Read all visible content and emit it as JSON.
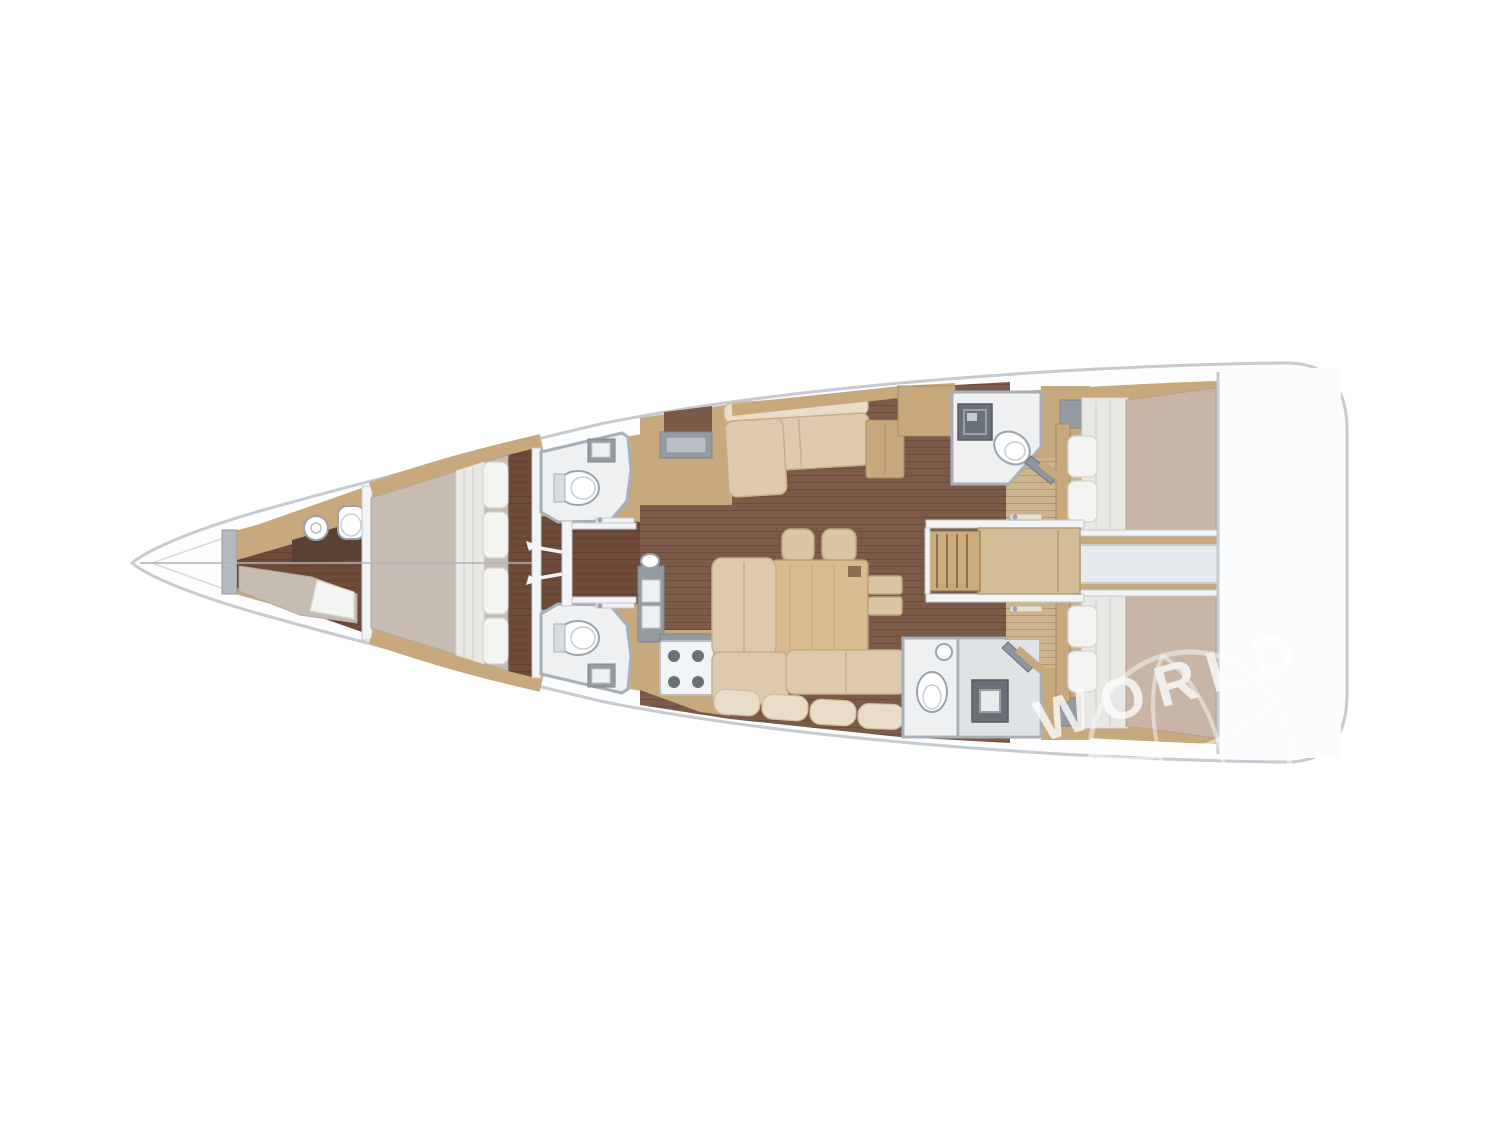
{
  "watermark": {
    "text": "WORLD"
  },
  "palette": {
    "hull_stroke": "#c6cbd1",
    "wood": "#c8a87d",
    "wood_dark": "#a98c62",
    "floor_corridor": "#6e4a39",
    "floor_salon": "#7b5a49",
    "floor_cabin": "#cdb48e",
    "mattress": "#c6bcb2",
    "sheet": "#eae8e4",
    "pillow": "#f4f4f2",
    "blanket": "#c8b5a5",
    "bath_floor": "#eef0f1",
    "bath_wall": "#a7b0b8",
    "shower": "#6a7077",
    "counter_gray": "#949ba1",
    "sofa": "#ddcaae",
    "sofa_light": "#e9ddc9",
    "table_wood": "#d8bb8e",
    "watermark": "#ffffff"
  }
}
